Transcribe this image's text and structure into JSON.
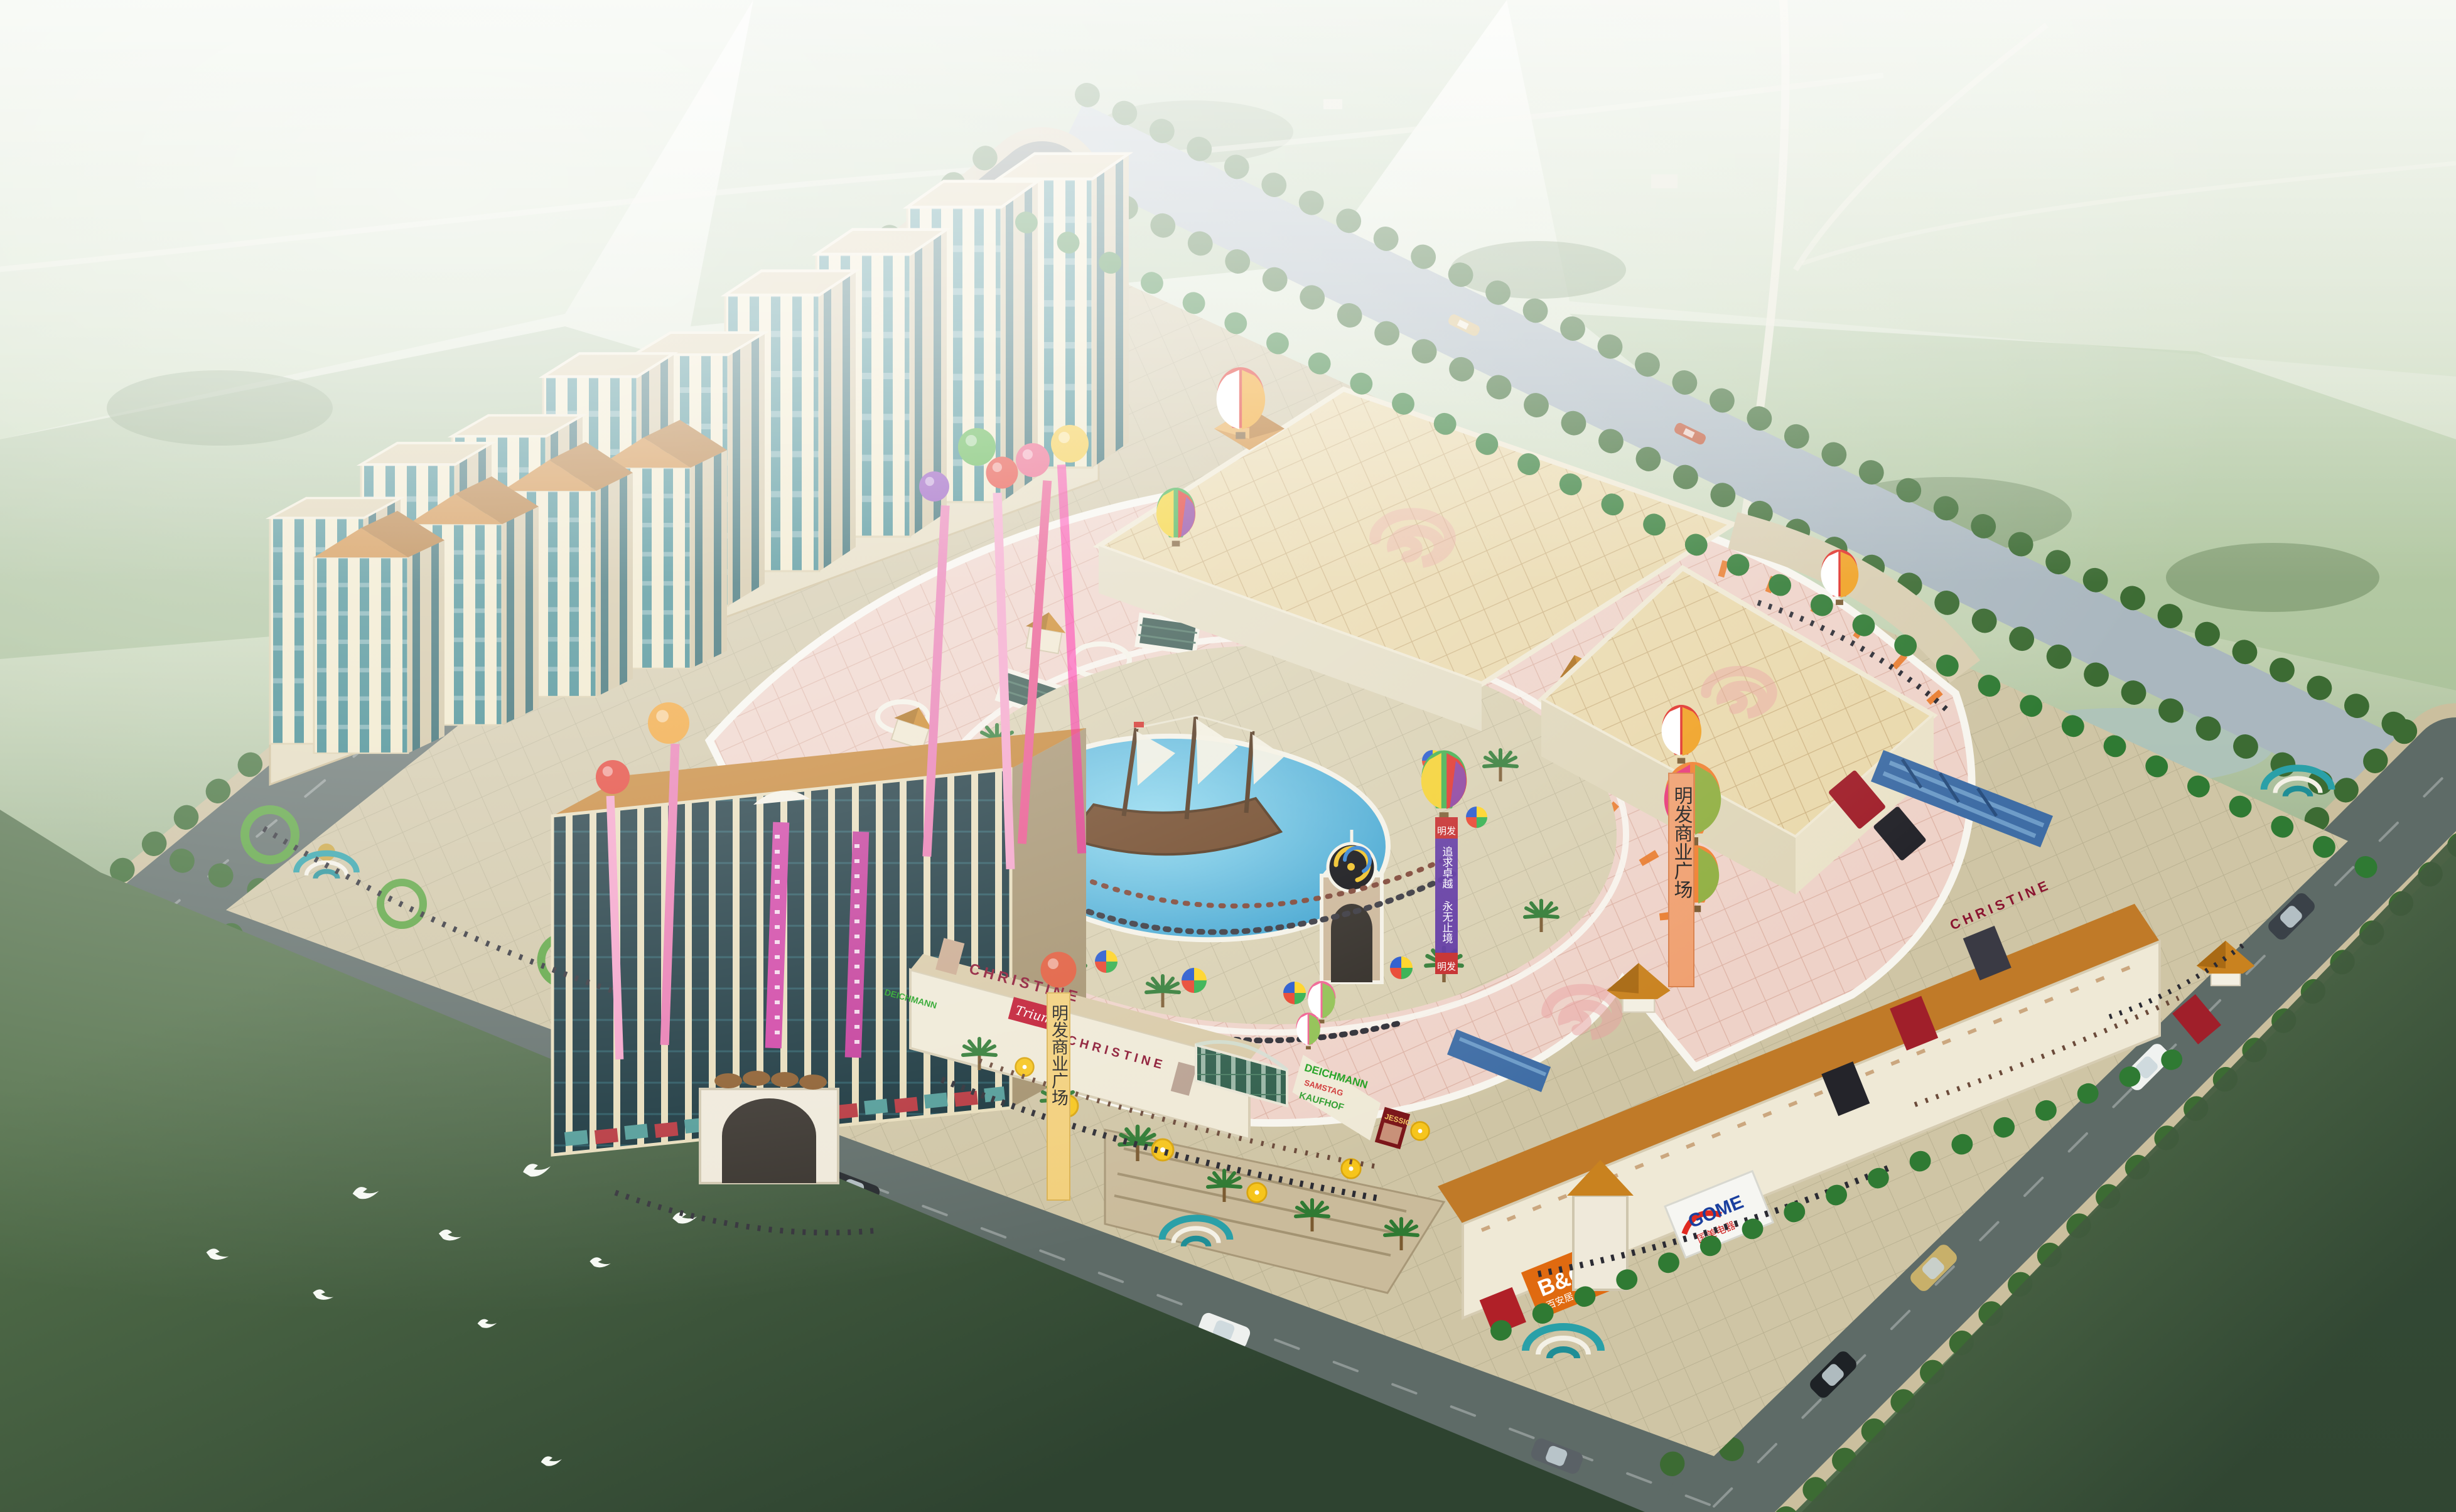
{
  "project": {
    "name_on_banners": "明发商业广场"
  },
  "banners": {
    "streamer_orange": "明发商业广场",
    "streamer_yellow": "明发商业广场",
    "purple_top": "明发",
    "purple_bottom": "明发",
    "purple_slogan": "追求卓越 永无止境"
  },
  "signs": {
    "south_christine_left": "CHRISTINE",
    "south_triumph": "Triumph",
    "south_christine_right": "CHRISTINE",
    "ne_christine": "CHRISTINE",
    "logo_wall": [
      "DEICHMANN",
      "SAMSTAG",
      "KAUFHOF"
    ],
    "logo_wall_left": "DEICHMANN",
    "jessica": "JESSICA",
    "bq": "B&Q",
    "bq_cn": "百安居",
    "gome": "GOME",
    "gome_cn": "国美电器"
  },
  "colors": {
    "haze": "#f2f5ec",
    "field_green": "#9db88e",
    "lawn_dark": "#3f5a3c",
    "road_asphalt": "#5e6b67",
    "sidewalk_tan": "#cbbf9e",
    "canal_water": "#aab7bf",
    "plaza_pink": "#eed2c8",
    "roof_tan": "#e9d8ab",
    "roof_orange": "#c9821f",
    "wall_cream": "#efe6c6",
    "glass_teal": "#2f7f86",
    "glass_dark": "#15323a",
    "pool_blue": "#45b0dc",
    "swirl_pink": "#e8a0a0",
    "banner_magenta": "#cf3fa3",
    "umbrella_yellow": "#f6c51c",
    "bq_orange": "#e06a10",
    "gome_blue": "#1a3f9e",
    "triumph_red": "#c01830"
  }
}
